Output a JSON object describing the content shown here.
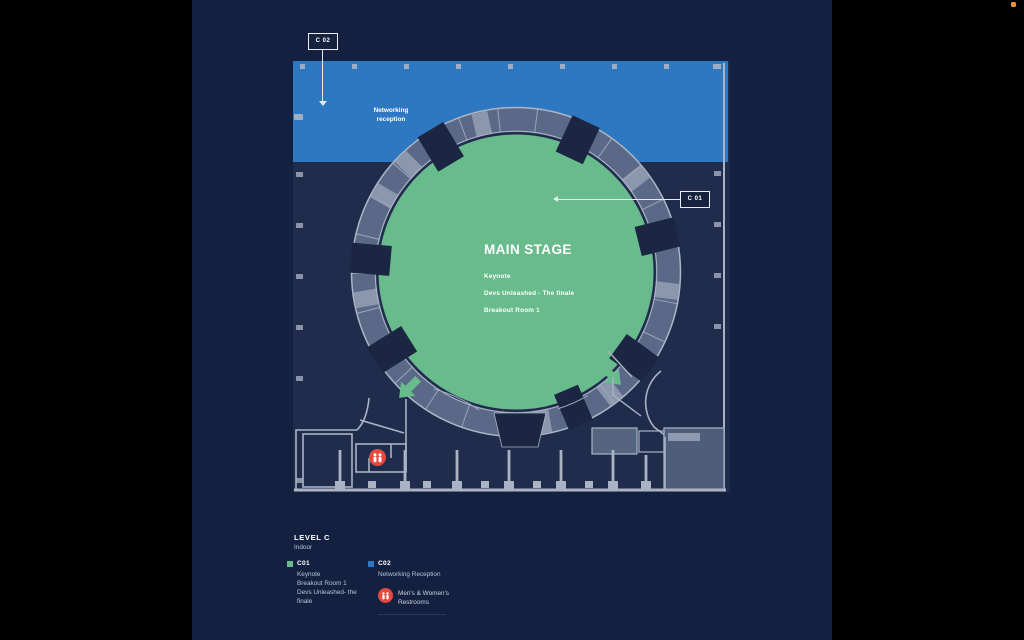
{
  "window": {
    "record_indicator": "orange-dot"
  },
  "map": {
    "networking": {
      "line1": "Networking",
      "line2": "reception"
    },
    "callouts": {
      "c01": "C 01",
      "c02": "C 02"
    },
    "stage": {
      "title": "MAIN STAGE",
      "sessions": [
        "Keynote",
        "Devs Unleashed - The finale",
        "Breakout Room 1"
      ]
    }
  },
  "legend": {
    "title": "LEVEL C",
    "subtitle": "Indoor",
    "items": [
      {
        "code": "C01",
        "color": "#68bc8b",
        "lines": [
          "Keynote",
          "Breakout Room 1",
          "Devs Unleashed- the finale"
        ]
      },
      {
        "code": "C02",
        "color": "#2e77c1",
        "lines": [
          "Networking Reception"
        ]
      }
    ],
    "restrooms": {
      "line1": "Men's & Women's",
      "line2": "Restrooms",
      "color": "#e8483d"
    }
  },
  "colors": {
    "background": "#000000",
    "panel": "#142040",
    "plan_floor": "#1f2c4c",
    "reception_blue": "#2e77c1",
    "stage_green": "#68bc8b",
    "ring_gray": "#5a6987",
    "wall_light": "#a9b3c3",
    "restroom_red": "#e8483d"
  }
}
